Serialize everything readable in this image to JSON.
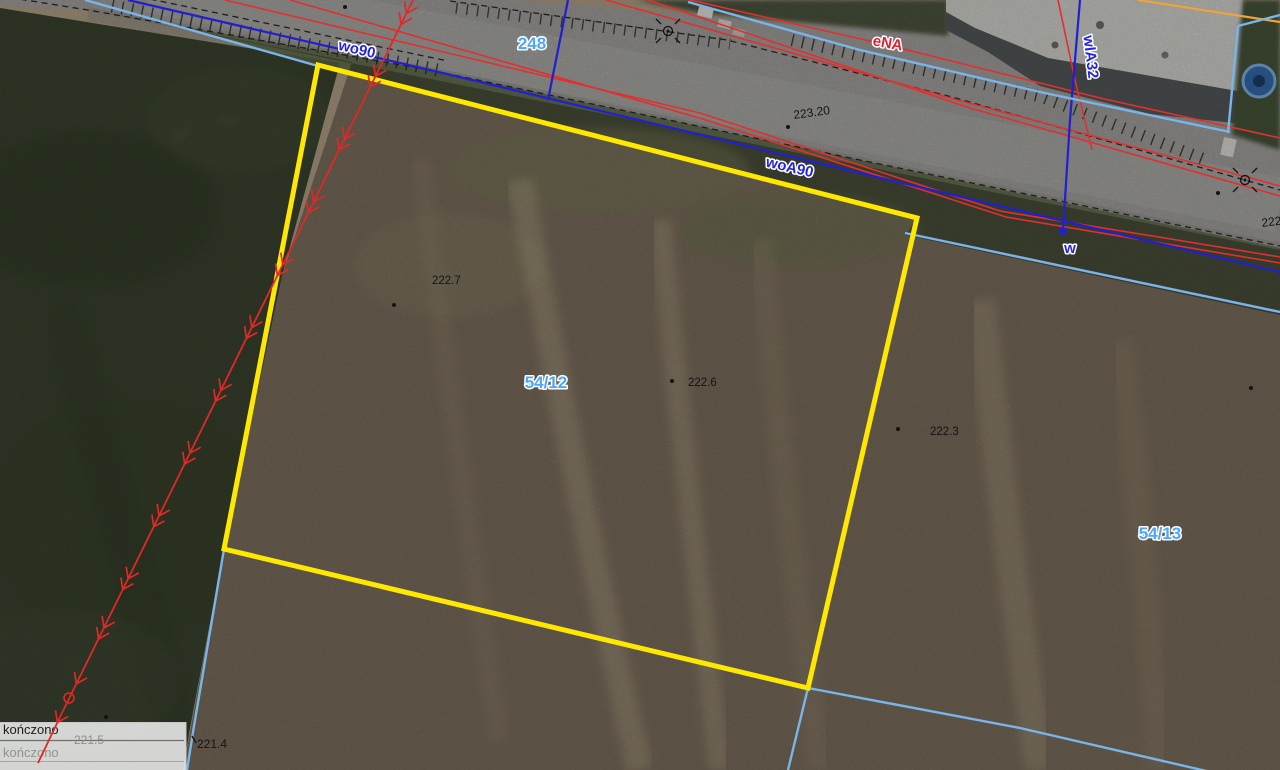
{
  "colors": {
    "parcel_highlight": "#ffe800",
    "boundary_blue": "#2020cf",
    "boundary_cyan": "#79b5e8",
    "utility_red": "#e03030",
    "utility_orange": "#eda43b",
    "parcel_label": "#4da6ff",
    "utility_label_blue": "#2525dd",
    "utility_label_red": "#e02030",
    "elevation_label": "#141414",
    "flow_arrow_red": "#e02828"
  },
  "labels": {
    "parcel_248": "248",
    "parcel_54_12": "54/12",
    "parcel_54_13": "54/13",
    "util_wo90": "wo90",
    "util_woA90": "woA90",
    "util_wlA32": "wlA32",
    "util_w": "w",
    "util_eNA": "eNA",
    "elev_223_20": "223.20",
    "elev_222_7": "222.7",
    "elev_222_6": "222.6",
    "elev_222_3": "222.3",
    "elev_221_4": "221.4",
    "elev_221_5": "221.5",
    "elev_edge_222": "222"
  },
  "panel": {
    "row1": "kończono",
    "row2": "kończono"
  }
}
